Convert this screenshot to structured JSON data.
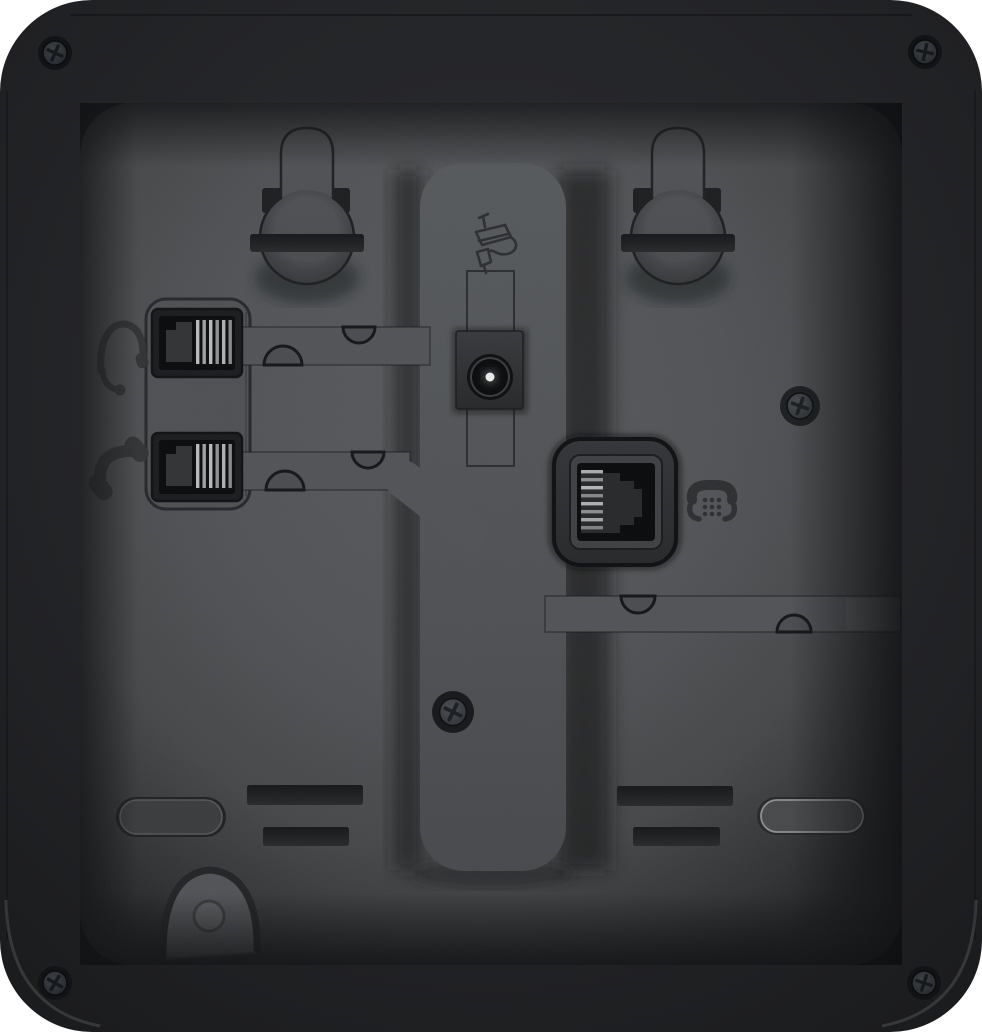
{
  "meta": {
    "title": "Rear panel of a black desk IP phone",
    "kind": "product-photo",
    "text_visible": "none"
  },
  "device": {
    "ports": [
      {
        "name": "headset-port",
        "icon": "headset-icon",
        "connector": "modular-jack"
      },
      {
        "name": "handset-port",
        "icon": "handset-icon",
        "connector": "modular-jack"
      },
      {
        "name": "dc-power-jack",
        "icon": "power-adapter-icon",
        "connector": "barrel-jack"
      },
      {
        "name": "line-port",
        "icon": "telephone-icon",
        "connector": "modular-jack"
      }
    ],
    "features": [
      "wall-mount-keyhole-left",
      "wall-mount-keyhole-right",
      "stand-column",
      "cable-routing-channels",
      "mounting-slots",
      "rubber-foot-left",
      "rubber-foot-right",
      "wall-hook-recess",
      "corner-screws"
    ],
    "screw_count": 6
  },
  "colors": {
    "background": "#ffffff",
    "body_dark": "#232427",
    "panel_center": "#56585b",
    "panel_edge": "#26272a",
    "column": "#525558",
    "slot_dark": "#1e1f21",
    "icon_engraving": "#303234",
    "contact_pins": "#b9babc",
    "power_pin_highlight": "#e8e9ea"
  }
}
